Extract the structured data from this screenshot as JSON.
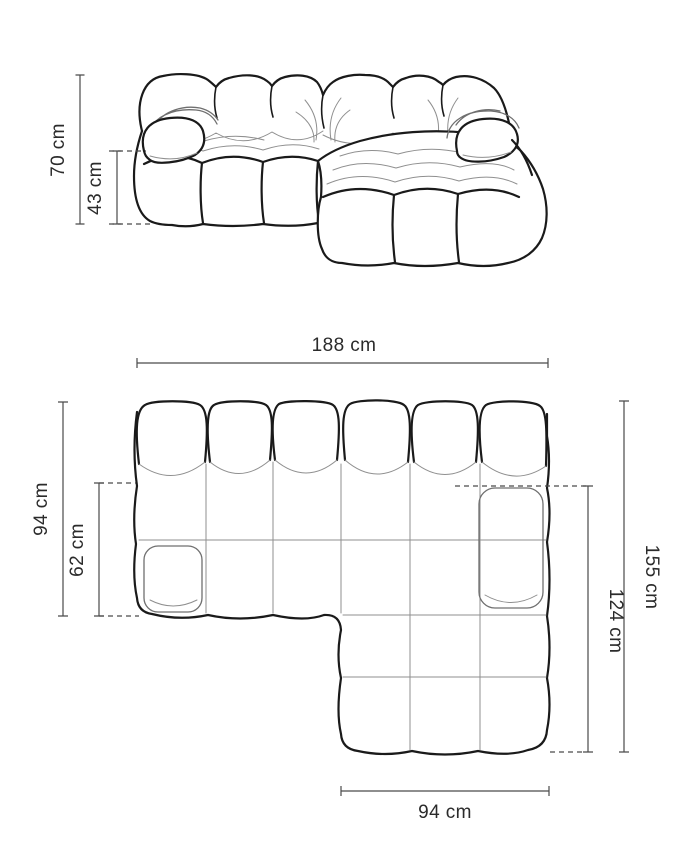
{
  "diagram": {
    "title": "modular-corner-sofa-dimension-drawing",
    "front": {
      "height_label": "70 cm",
      "seat_height_label": "43 cm"
    },
    "top": {
      "width_label": "188 cm",
      "depth_label": "94 cm",
      "seat_depth_label": "62 cm",
      "total_depth_label": "155 cm",
      "chaise_depth_label": "124 cm",
      "chaise_width_label": "94 cm"
    },
    "colors": {
      "outline": "#1a1a1a",
      "crease": "#8f8f8f",
      "dimension": "#4a4a4a",
      "label": "#2b2b2b",
      "background": "#ffffff"
    }
  }
}
